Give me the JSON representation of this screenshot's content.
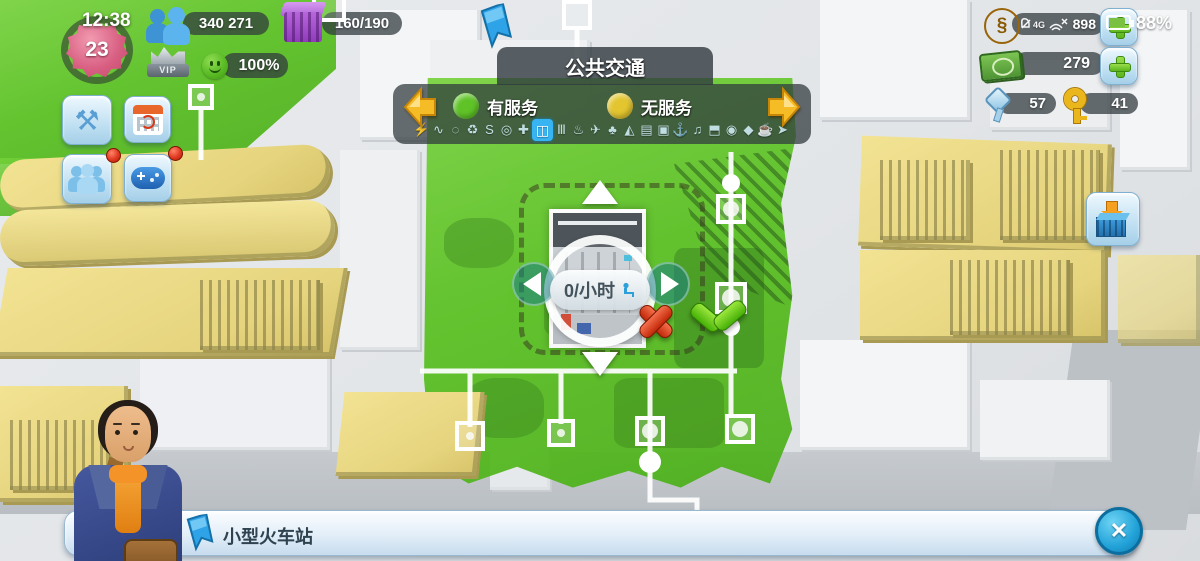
{
  "hud": {
    "time": "12:38",
    "level": "23",
    "population": "340 271",
    "storage": "160/190",
    "happiness": "100%",
    "vip_label": "VIP",
    "coin_symbol": "§"
  },
  "statusbar": {
    "network": "4G",
    "coins_visible": "898",
    "battery": "88%"
  },
  "resources": {
    "simcash": "279",
    "platinum_keys": "57",
    "golden_keys": "41"
  },
  "panel": {
    "title": "公共交通",
    "legend": [
      {
        "label": "有服务",
        "color": "#5fc327"
      },
      {
        "label": "无服务",
        "color": "#e3c52f"
      }
    ],
    "services": [
      {
        "name": "power",
        "glyph": "⚡",
        "active": false
      },
      {
        "name": "water",
        "glyph": "∿",
        "active": false
      },
      {
        "name": "sewage",
        "glyph": "◌",
        "active": false
      },
      {
        "name": "waste",
        "glyph": "♻",
        "active": false
      },
      {
        "name": "roads",
        "glyph": "S",
        "active": false
      },
      {
        "name": "police",
        "glyph": "◎",
        "active": false
      },
      {
        "name": "health",
        "glyph": "✚",
        "active": false
      },
      {
        "name": "transport",
        "glyph": "◫",
        "active": true
      },
      {
        "name": "education",
        "glyph": "Ⅲ",
        "active": false
      },
      {
        "name": "fire",
        "glyph": "♨",
        "active": false
      },
      {
        "name": "airport",
        "glyph": "✈",
        "active": false
      },
      {
        "name": "parks",
        "glyph": "♣",
        "active": false
      },
      {
        "name": "beach",
        "glyph": "◭",
        "active": false
      },
      {
        "name": "regions",
        "glyph": "▤",
        "active": false
      },
      {
        "name": "bus",
        "glyph": "▣",
        "active": false
      },
      {
        "name": "seaport",
        "glyph": "⚓",
        "active": false
      },
      {
        "name": "entertainment",
        "glyph": "♫",
        "active": false
      },
      {
        "name": "cable-car",
        "glyph": "⬒",
        "active": false
      },
      {
        "name": "camera",
        "glyph": "◉",
        "active": false
      },
      {
        "name": "gem",
        "glyph": "◆",
        "active": false
      },
      {
        "name": "casino",
        "glyph": "☕",
        "active": false
      },
      {
        "name": "rocket",
        "glyph": "➤",
        "active": false
      }
    ]
  },
  "placement": {
    "rate": "0/小时"
  },
  "banner": {
    "title": "小型火车站",
    "close_glyph": "✕"
  },
  "colors": {
    "service_green": "#5fc327",
    "no_service_yellow": "#e3c52f",
    "accent_blue": "#29a8e0"
  }
}
